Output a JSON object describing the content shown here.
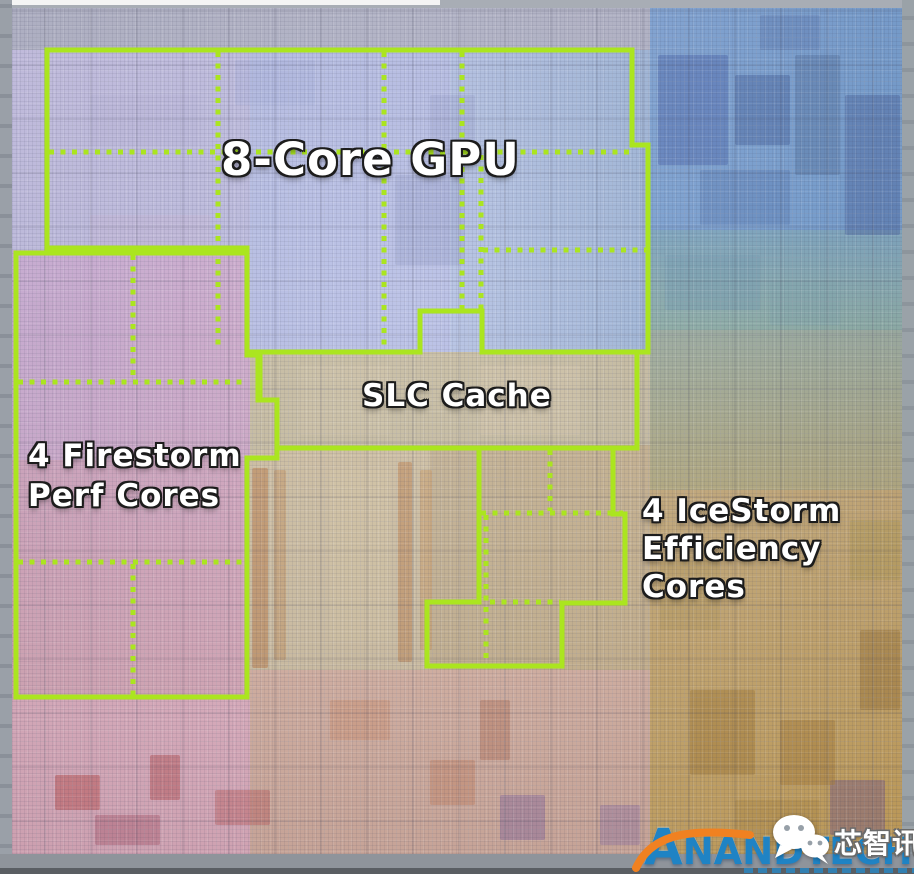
{
  "colors": {
    "annotation_green": "#abe51f",
    "anandtech_blue": "#1f83c4",
    "swoosh_orange": "#f08121"
  },
  "regions": {
    "gpu": {
      "label": "8-Core GPU"
    },
    "slc_cache": {
      "label": "SLC Cache"
    },
    "firestorm": {
      "lines": [
        "4 Firestorm",
        "Perf Cores"
      ]
    },
    "icestorm": {
      "lines": [
        "4 IceStorm",
        "Efficiency",
        "Cores"
      ]
    }
  },
  "watermarks": {
    "anandtech": {
      "text": "ANANDTECH"
    },
    "wechat_account": {
      "name": "芯智讯"
    }
  }
}
